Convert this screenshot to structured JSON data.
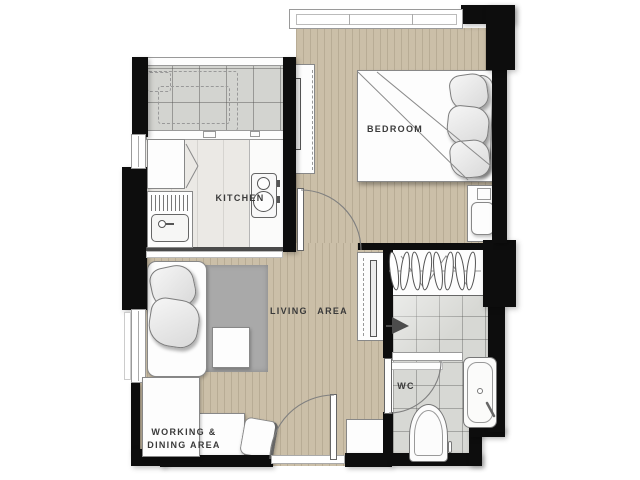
{
  "title": "apartment-floor-plan",
  "labels": {
    "bedroom": "BEDROOM",
    "kitchen": "KITCHEN",
    "living_area": "LIVING AREA",
    "wc": "WC",
    "working_dining_line1": "WORKING &",
    "working_dining_line2": "DINING AREA"
  },
  "colors": {
    "wall": "#0d0d0d",
    "wood_floor": "#cbbfa8",
    "counter_tile": "#d3d4d0",
    "kitchen_floor": "#ebe9e5",
    "bath_tile": "#d7d8d4",
    "rug": "#a9a9a9",
    "fixture_white": "#fdfdfd",
    "outline": "#777777",
    "label_text": "#3a3a3a",
    "door_arc": "#7f7f7f"
  }
}
